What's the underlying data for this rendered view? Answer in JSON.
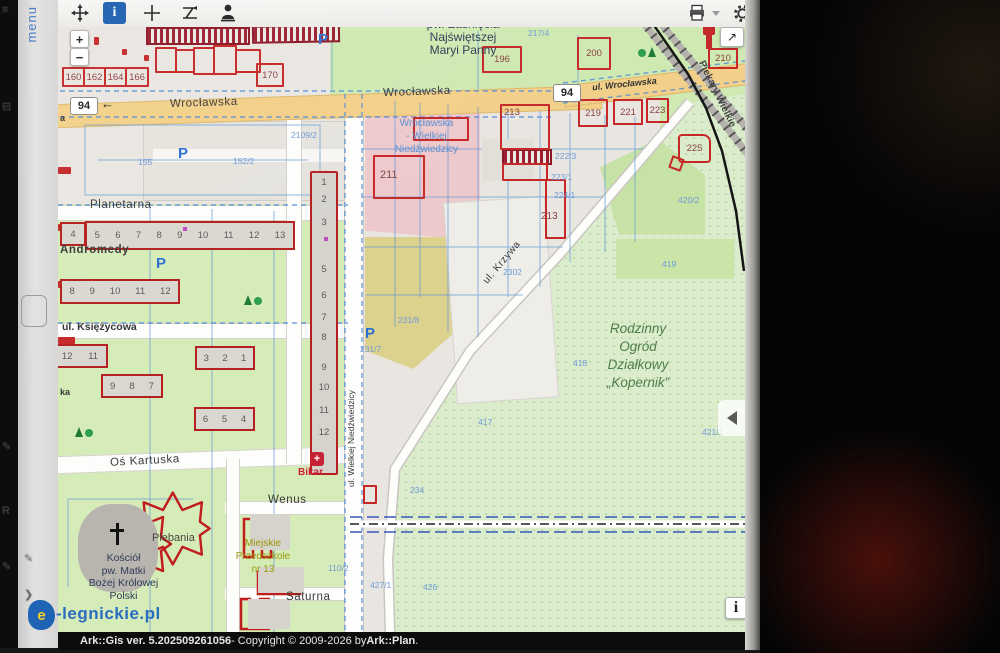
{
  "sidebar": {
    "menu": "menu"
  },
  "zoomctl": {
    "in": "+",
    "out": "−"
  },
  "shield": "94",
  "misc": {
    "p": "P",
    "arrow_left": "←",
    "arrow_ne": "↗",
    "info_i": "i",
    "a": "a",
    "ka": "ka",
    "cross": "+"
  },
  "streets": {
    "wroclawska": "Wrocławska",
    "ul_wroclawska": "ul. Wrocławska",
    "planetarna": "Planetarna",
    "andromedy": "Andromedy",
    "ksiezycowa": "ul. Księżycowa",
    "os_kartuska": "Oś Kartuska",
    "wenus": "Wenus",
    "saturna": "Saturna",
    "krzywa": "ul. Krzywa",
    "niedzwiedzicy": "ul. Wielkiej Niedźwiedzicy",
    "piekary": "Piekary Wielkie"
  },
  "labels": {
    "church_n": [
      "pw. Zaśnięcia",
      "Najświętszej",
      "Maryi Panny"
    ],
    "pink": [
      "Wrocławska",
      "- Wielkiej",
      "Niedźwiedzicy"
    ],
    "rod": [
      "Rodzinny",
      "Ogród",
      "Działkowy",
      "„Kopernik”"
    ],
    "kosciol": [
      "Kościół",
      "pw. Matki",
      "Bożej Królowej",
      "Polski"
    ],
    "plebania": "Plebania",
    "przedszkole": [
      "Miejskie",
      "Przedszkole",
      "nr 13"
    ],
    "bikar": "Bikar"
  },
  "parcels": {
    "p160": "160",
    "p162": "162",
    "p164": "164",
    "p166": "166",
    "p170": "170",
    "p196": "196",
    "p200": "200",
    "p210": "210",
    "p211": "211",
    "p213a": "213",
    "p213b": "213",
    "p219": "219",
    "p221": "221",
    "p223": "223",
    "p225": "225"
  },
  "bluenums": {
    "n155": "155",
    "n152": "152/2",
    "n2109": "2109/2",
    "n217": "217/4",
    "n2223": "222/3",
    "n2231": "223/1",
    "n2241": "224/1",
    "n4202": "420/2",
    "n2302": "2302",
    "n2317": "231/7",
    "n2318": "231/8",
    "n418": "418",
    "n417": "417",
    "n419": "419",
    "n421": "421/1",
    "n234": "234",
    "n426": "426",
    "n427": "427/1",
    "n110": "110/2"
  },
  "blocks": {
    "b4": "4",
    "row1": [
      "5",
      "6",
      "7",
      "8",
      "9",
      "10",
      "11",
      "12",
      "13"
    ],
    "row2": [
      "8",
      "9",
      "10",
      "11",
      "12"
    ],
    "k1": [
      "12",
      "11"
    ],
    "k2": [
      "9",
      "8",
      "7"
    ],
    "k3": [
      "3",
      "2",
      "1"
    ],
    "k4": [
      "6",
      "5",
      "4"
    ]
  },
  "tower": [
    "1",
    "2",
    "3",
    "5",
    "6",
    "7",
    "8",
    "9",
    "10",
    "11",
    "12"
  ],
  "logo": {
    "e": "e",
    "text": "-legnickie.pl"
  },
  "statusbar": {
    "app": "Ark::Gis ver. 5.202509261056",
    "mid": " - Copyright © 2009-2026 by ",
    "brand": "Ark::Plan",
    "dot": "."
  }
}
